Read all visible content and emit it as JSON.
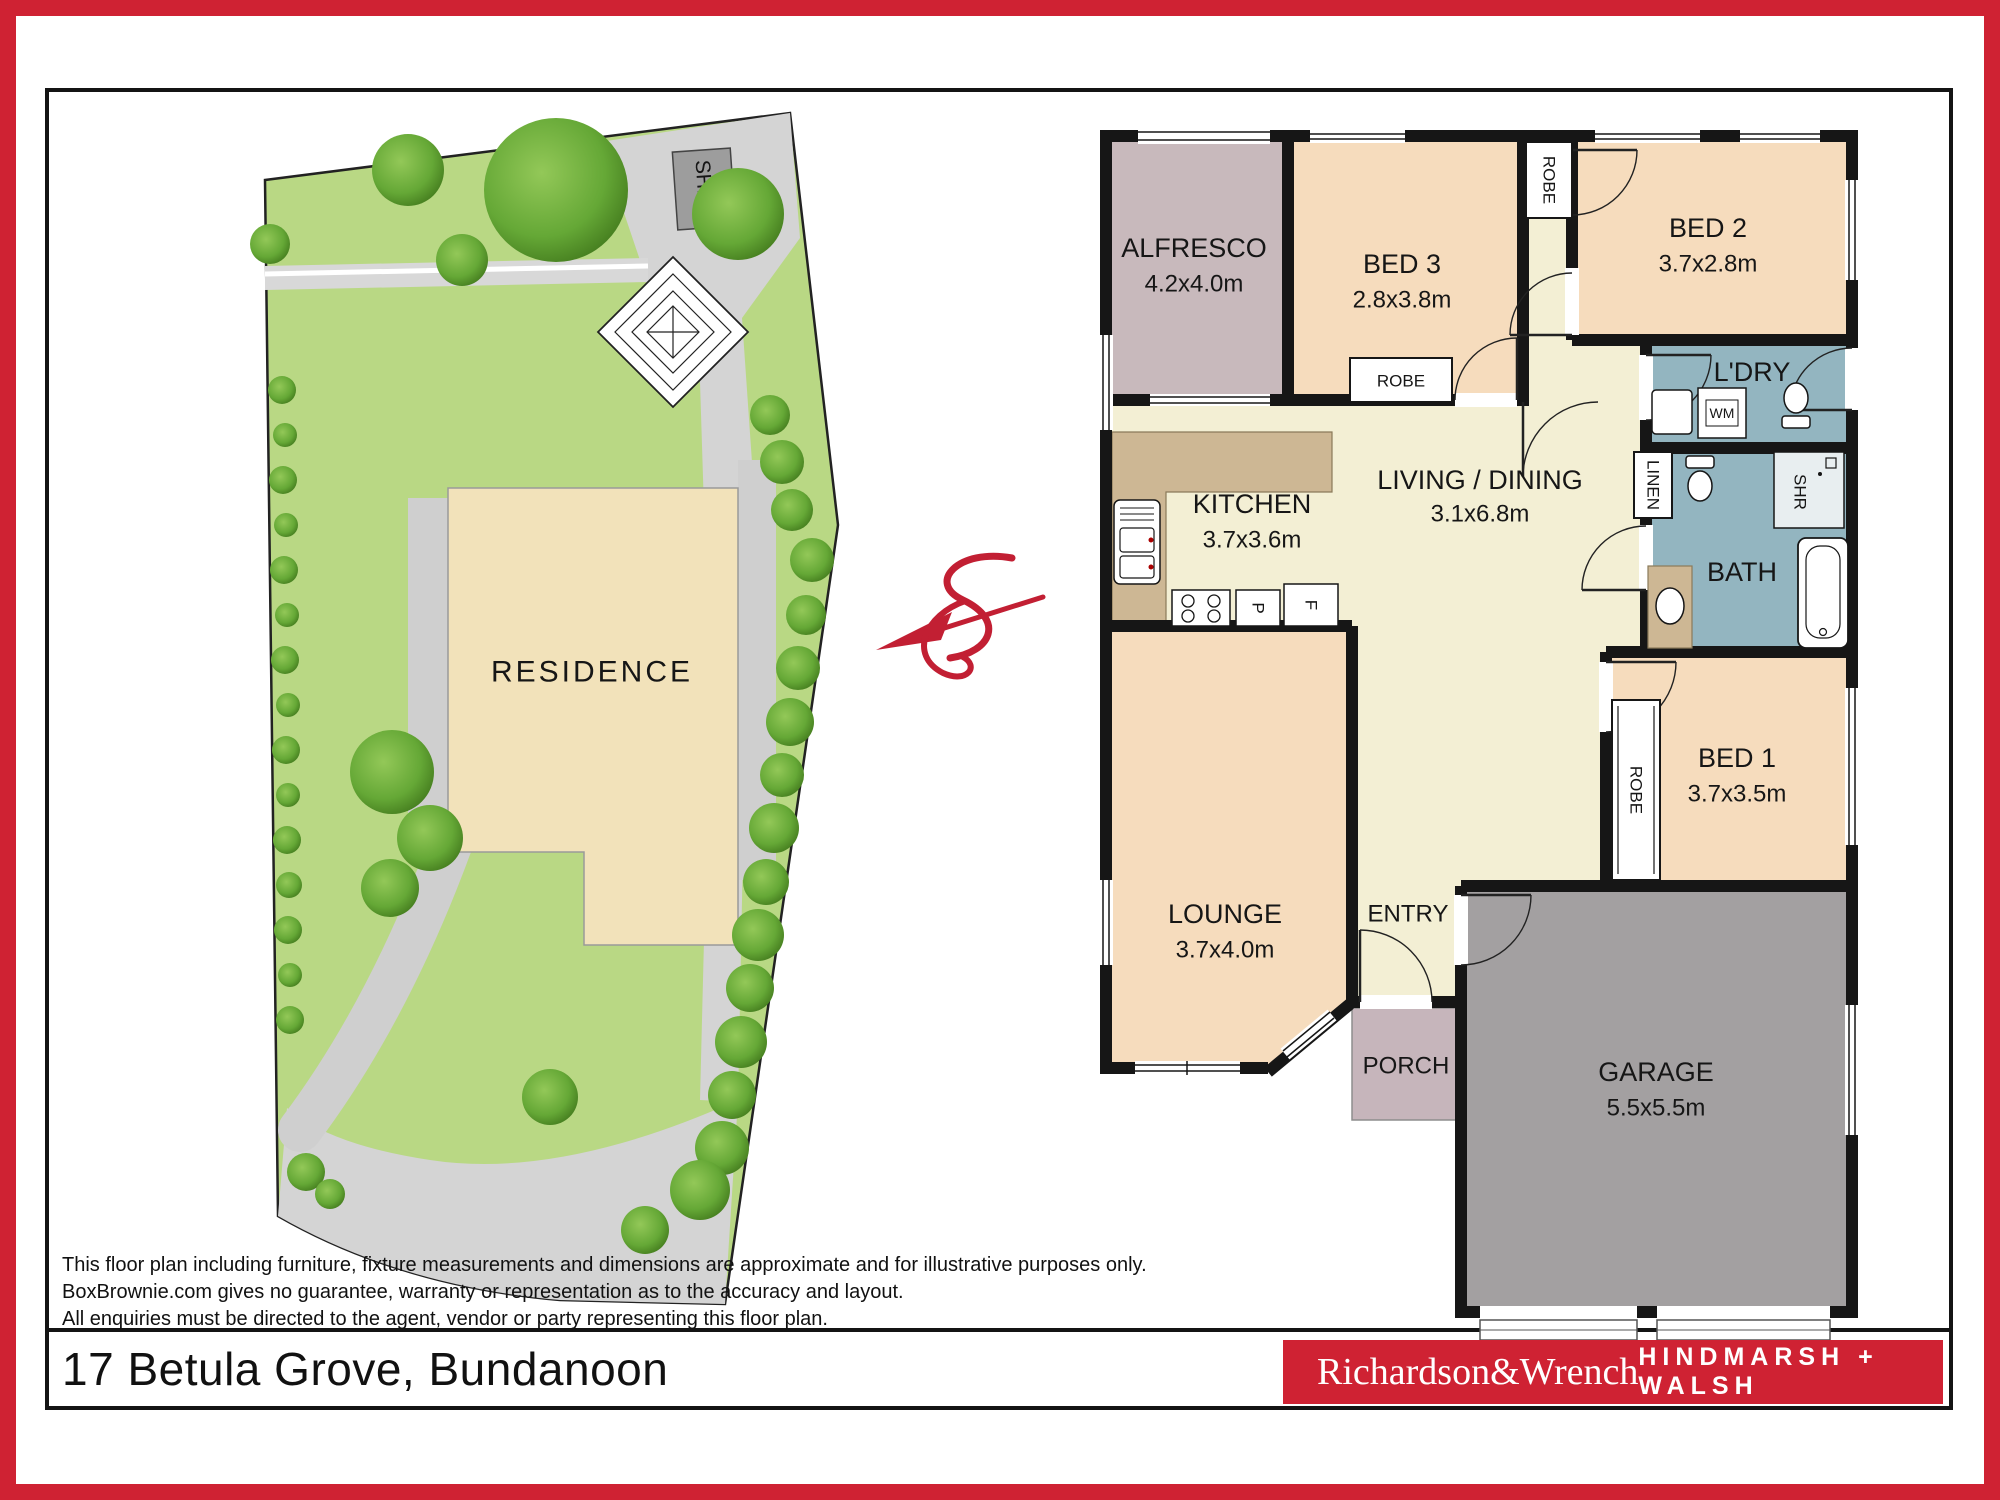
{
  "site_plan": {
    "residence": "RESIDENCE",
    "shed": "SHED"
  },
  "floor_plan": {
    "alfresco": {
      "name": "ALFRESCO",
      "dims": "4.2x4.0m"
    },
    "bed3": {
      "name": "BED 3",
      "dims": "2.8x3.8m"
    },
    "bed2": {
      "name": "BED 2",
      "dims": "3.7x2.8m"
    },
    "ldry": {
      "name": "L'DRY"
    },
    "bath": {
      "name": "BATH"
    },
    "kitchen": {
      "name": "KITCHEN",
      "dims": "3.7x3.6m"
    },
    "living": {
      "name": "LIVING / DINING",
      "dims": "3.1x6.8m"
    },
    "bed1": {
      "name": "BED 1",
      "dims": "3.7x3.5m"
    },
    "lounge": {
      "name": "LOUNGE",
      "dims": "3.7x4.0m"
    },
    "entry": {
      "name": "ENTRY"
    },
    "porch": {
      "name": "PORCH"
    },
    "garage": {
      "name": "GARAGE",
      "dims": "5.5x5.5m"
    },
    "labels": {
      "robe": "ROBE",
      "linen": "LINEN",
      "shr": "SHR",
      "wm": "WM",
      "pantry": "P",
      "fridge": "F"
    }
  },
  "footer": {
    "disclaimer": [
      "This floor plan including furniture, fixture measurements and dimensions are approximate and for illustrative purposes only.",
      "BoxBrownie.com gives no guarantee, warranty or representation as to the accuracy and layout.",
      "All enquiries must be directed to the agent, vendor or party representing this floor plan."
    ],
    "address": "17 Betula Grove, Bundanoon",
    "logo_left": "Richardson&Wrench",
    "logo_right": "HINDMARSH + WALSH"
  }
}
